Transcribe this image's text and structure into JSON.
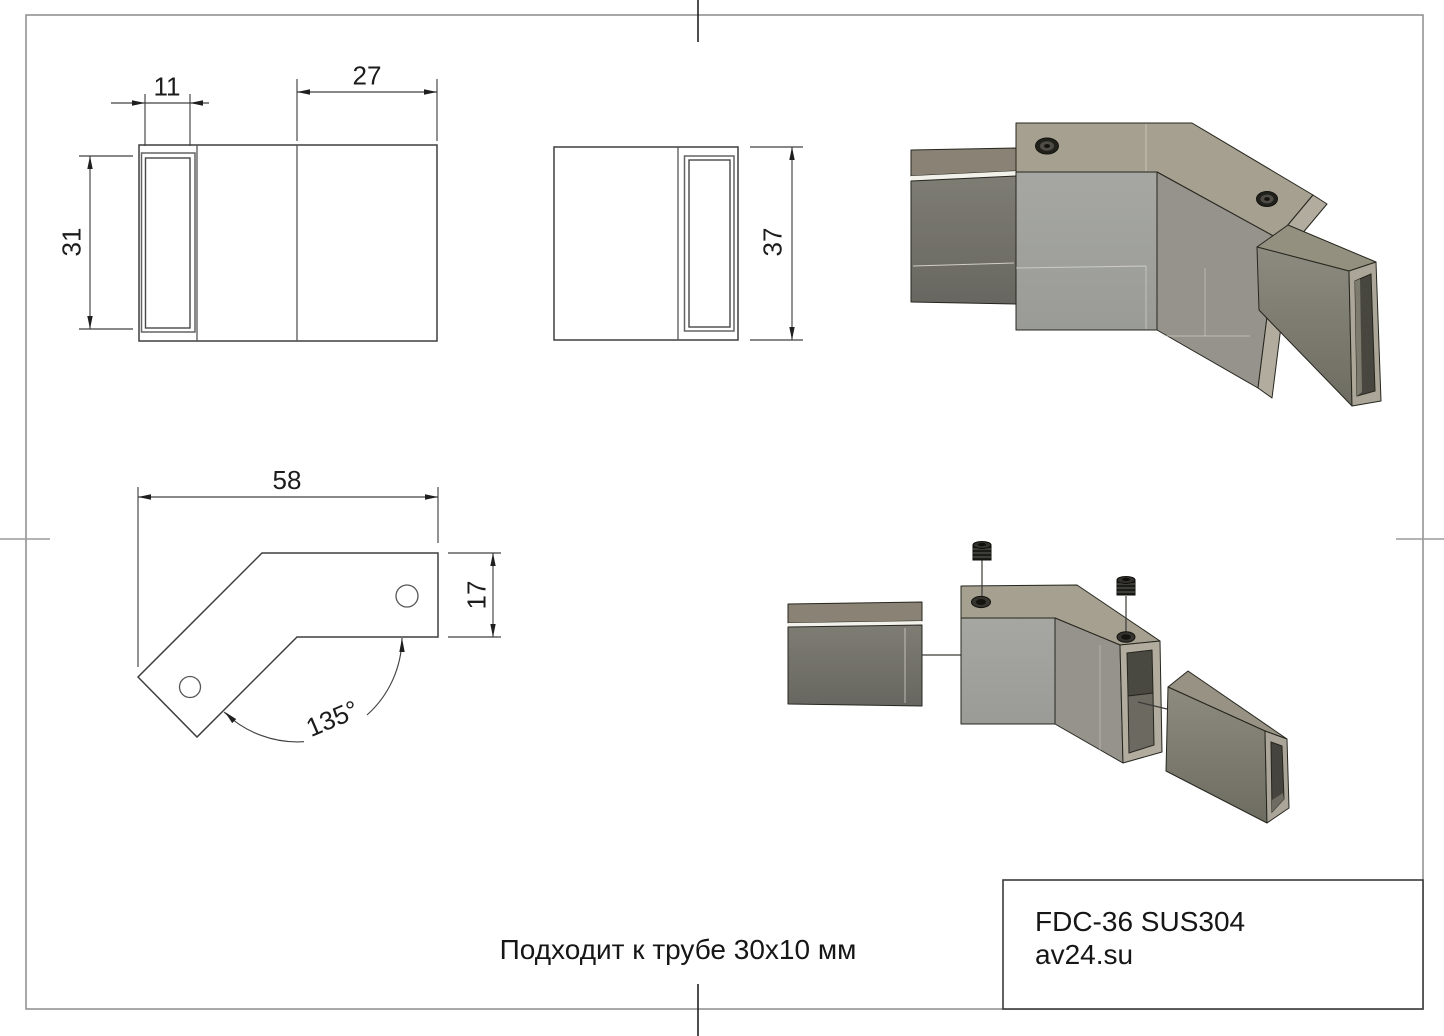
{
  "sheet": {
    "background": "#ffffff",
    "note": "Подходит к трубе 30x10 мм"
  },
  "title_block": {
    "model": "FDC-36 SUS304",
    "website": "av24.su"
  },
  "views": {
    "front": {
      "dim_tab_width": "11",
      "dim_body_width": "27",
      "dim_tube_height": "31"
    },
    "side": {
      "dim_height": "37"
    },
    "plan": {
      "dim_length": "58",
      "dim_arm_width": "17",
      "dim_angle": "135°"
    }
  },
  "colors": {
    "drawing_line": "#3f3f3f",
    "dimension_line": "#414141",
    "frame": "#8c8c8c",
    "render_top_face": "#a5a08f",
    "render_front_face": "#a2a39f",
    "render_angled_face": "#95938b",
    "render_tube_top": "#8a8375",
    "render_tube_front": "#7b7a71",
    "render_end_ring": "#b1ac9e",
    "render_interior": "#48473f",
    "screw": "#1b1b18"
  }
}
